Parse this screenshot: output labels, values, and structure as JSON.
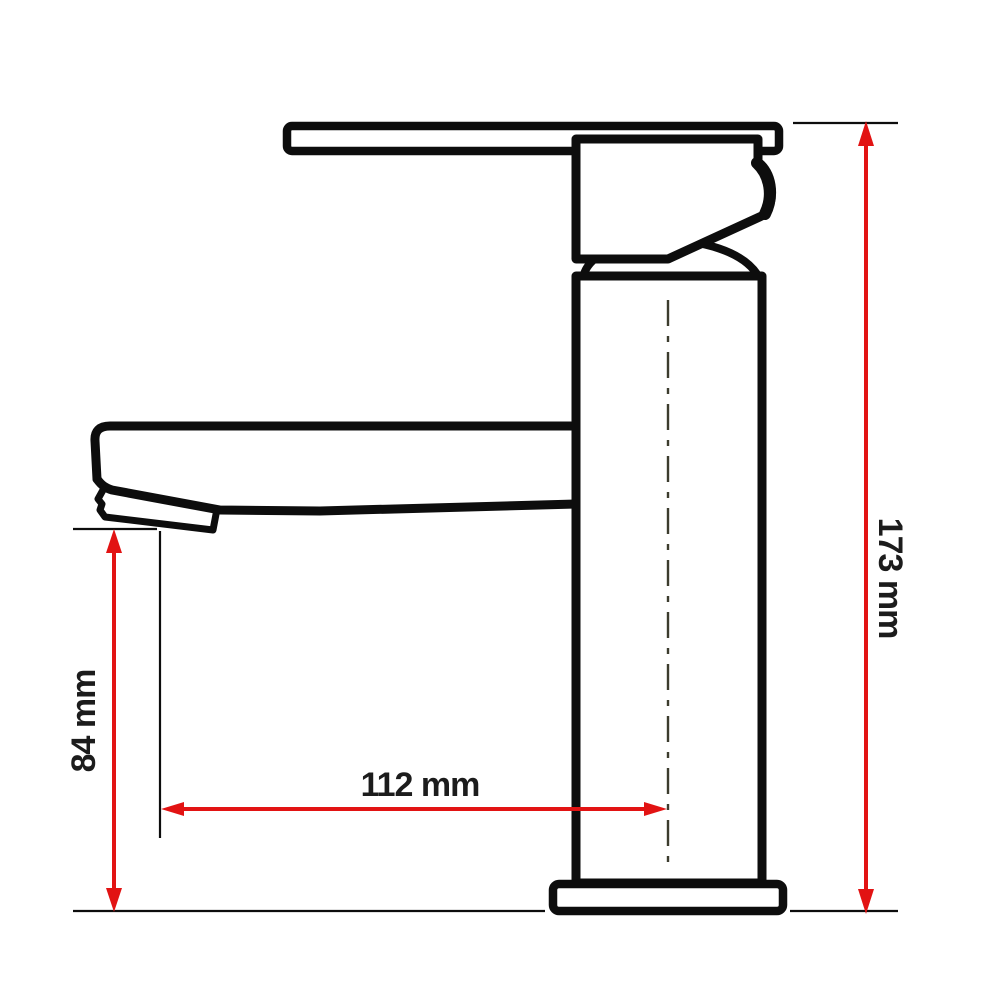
{
  "dimensions": {
    "spout_height": {
      "label": "84 mm",
      "value": 84,
      "unit": "mm"
    },
    "spout_reach": {
      "label": "112 mm",
      "value": 112,
      "unit": "mm"
    },
    "overall_height": {
      "label": "173 mm",
      "value": 173,
      "unit": "mm"
    }
  },
  "colors": {
    "dimension_line": "#e21313",
    "drawing_line": "#0d0d0d",
    "centerline": "#3c3c2e",
    "label_text": "#1c1c1c",
    "background": "#ffffff"
  }
}
